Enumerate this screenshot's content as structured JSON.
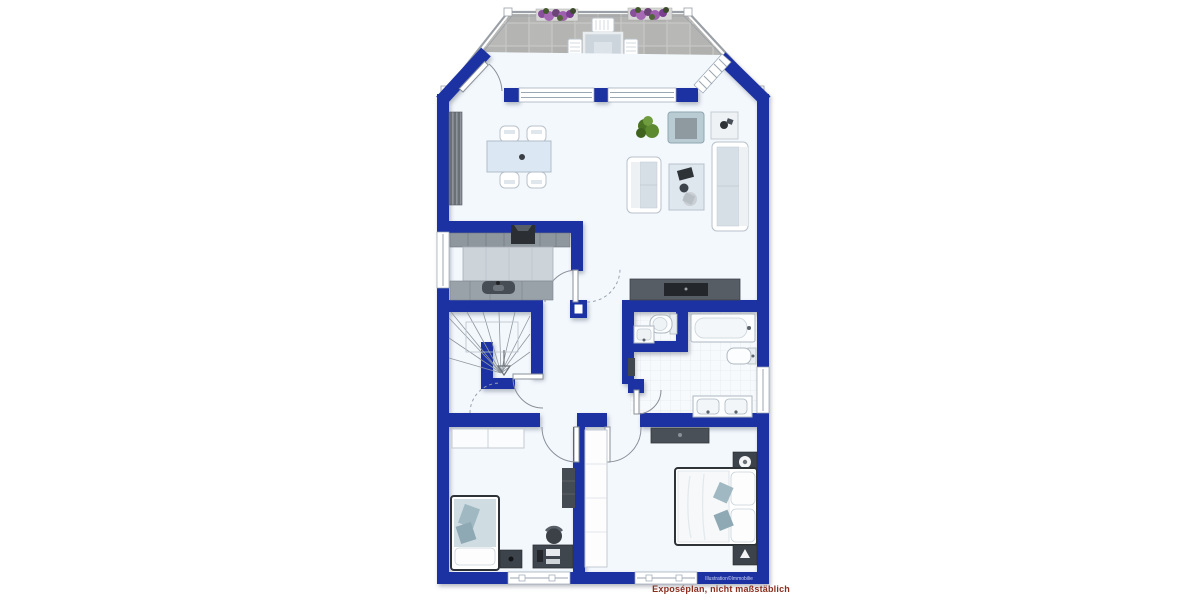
{
  "plan": {
    "watermark": "Illustration©Immobilie",
    "footer_note": "Exposéplan, nicht maßstäblich"
  },
  "colors": {
    "wall_blue": "#1d31a3",
    "floor_white": "#f3f8fd",
    "terrace_tile_gray": "#b4b4b2",
    "terrace_grout": "#c7c7c5",
    "furniture_dark_gray": "#3d434a",
    "kitchen_cabinet_gray": "#8f979e",
    "counter_light_gray": "#ccd3d9",
    "textile_accent_blue": "#9fb8c2",
    "plant_green": "#5d8a2e",
    "flower_purple": "#9d5fae",
    "fixture_outline": "#aeb8c0",
    "door_swing_gray": "#8a9099",
    "footer_text_red": "#8b2e1e"
  }
}
